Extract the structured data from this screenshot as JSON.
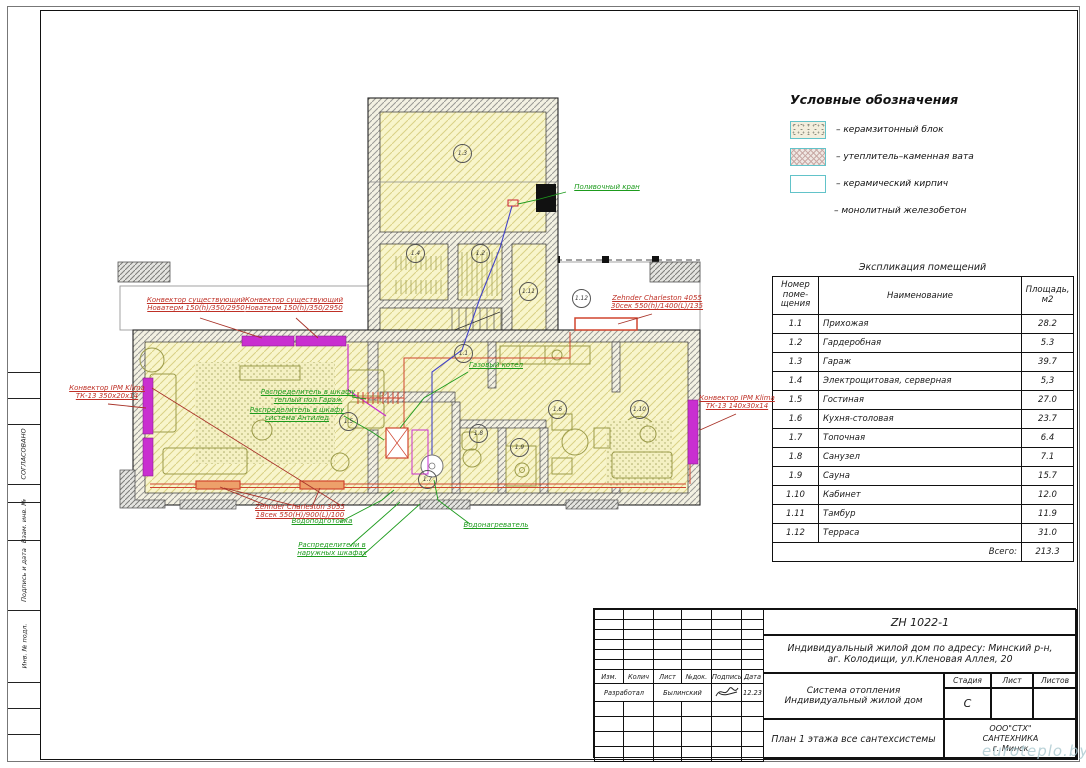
{
  "legend": {
    "title": "Условные обозначения",
    "items": [
      {
        "label": "–  керамзитонный блок"
      },
      {
        "label": "–  утеплитель–каменная вата"
      },
      {
        "label": "–  керамический кирпич"
      },
      {
        "label": "–  монолитный железобетон"
      }
    ]
  },
  "explication_table": {
    "title": "Экспликация помещений",
    "col1_l1": "Номер",
    "col1_l2": "поме-",
    "col1_l3": "щения",
    "col2": "Наименование",
    "col3_l1": "Площадь,",
    "col3_l2": "м2",
    "rows": [
      [
        "1.1",
        "Прихожая",
        "28.2"
      ],
      [
        "1.2",
        "Гардеробная",
        "5.3"
      ],
      [
        "1.3",
        "Гараж",
        "39.7"
      ],
      [
        "1.4",
        "Электрощитовая, серверная",
        "5,3"
      ],
      [
        "1.5",
        "Гостиная",
        "27.0"
      ],
      [
        "1.6",
        "Кухня-столовая",
        "23.7"
      ],
      [
        "1.7",
        "Топочная",
        "6.4"
      ],
      [
        "1.8",
        "Санузел",
        "7.1"
      ],
      [
        "1.9",
        "Сауна",
        "15.7"
      ],
      [
        "1.10",
        "Кабинет",
        "12.0"
      ],
      [
        "1.11",
        "Тамбур",
        "11.9"
      ],
      [
        "1.12",
        "Терраса",
        "31.0"
      ]
    ],
    "total_label": "Всего:",
    "total_value": "213.3"
  },
  "title_block": {
    "doc_number": "ZH 1022-1",
    "address_line1": "Индивидуальный жилой дом по адресу: Минский р-н,",
    "address_line2": "аг. Колодищи, ул.Кленовая Аллея, 20",
    "header_cols": [
      "Изм.",
      "Колич",
      "Лист",
      "№док.",
      "Подпись",
      "Дата"
    ],
    "developed_label": "Разработал",
    "developer_name": "Былинский",
    "date": "12.23",
    "system_line1": "Система отопления",
    "system_line2": "Индивидуальный жилой дом",
    "stage_label": "Стадия",
    "sheet_label": "Лист",
    "sheets_label": "Листов",
    "stage_value": "С",
    "sheet_title": "План 1 этажа все сантехсистемы",
    "company_line1": "ООО\"СТХ\"",
    "company_line2": "САНТЕХНИКА",
    "company_line3": "г. Минск"
  },
  "side_strip": {
    "approved": "СОГЛАСОВАНО",
    "vzam": "Взам. инв. №",
    "podpis": "Подпись и дата",
    "inv": "Инв. № подл."
  },
  "plan": {
    "rooms": [
      "1.1",
      "1.2",
      "1.3",
      "1.4",
      "1.5",
      "1.6",
      "1.7",
      "1.8",
      "1.9",
      "1.10",
      "1.11",
      "1.12"
    ],
    "annotations": {
      "conv_exist": {
        "line1": "Конвектор существующий",
        "line2": "Новатерм 150(h)/350/2950"
      },
      "conv_ipm_left": {
        "line1": "Конвектор IPM Klima",
        "line2": "ТК-13 350х20х14"
      },
      "conv_ipm_right": {
        "line1": "Конвектор IPM Klima",
        "line2": "ТК-13 140х30х14"
      },
      "zehnder_4055": {
        "line1": "Zehnder Charleston 4055",
        "line2": "30сек 550(h)/1400(L)/135"
      },
      "zehnder_3055": {
        "line1": "Zehnder Charleston 3055",
        "line2": "18сек 550(H)/900(L)/100"
      },
      "poliv_kran": "Поливочный кран",
      "gas_kotel": "Газовый котел",
      "raspr_garage": {
        "line1": "Распределитель  в шкафу",
        "line2": "теплый пол Гараж"
      },
      "raspr_antiled": {
        "line1": "Распределитель  в шкафу",
        "line2": "система Антилед"
      },
      "vodopodgotovka": "Водоподготовка",
      "raspr_naruzh": {
        "line1": "Распределители  в",
        "line2": "наружных шкафах"
      },
      "vodonagrevatel": "Водонагреватель"
    },
    "colors": {
      "convector_magenta": "#c92fd0",
      "radiator_red": "#d0452f",
      "pipe_blue": "#4444c8",
      "annotation_green": "#1d9b1d",
      "annotation_red": "#bf3026"
    }
  },
  "watermark": "euroteplo.by"
}
